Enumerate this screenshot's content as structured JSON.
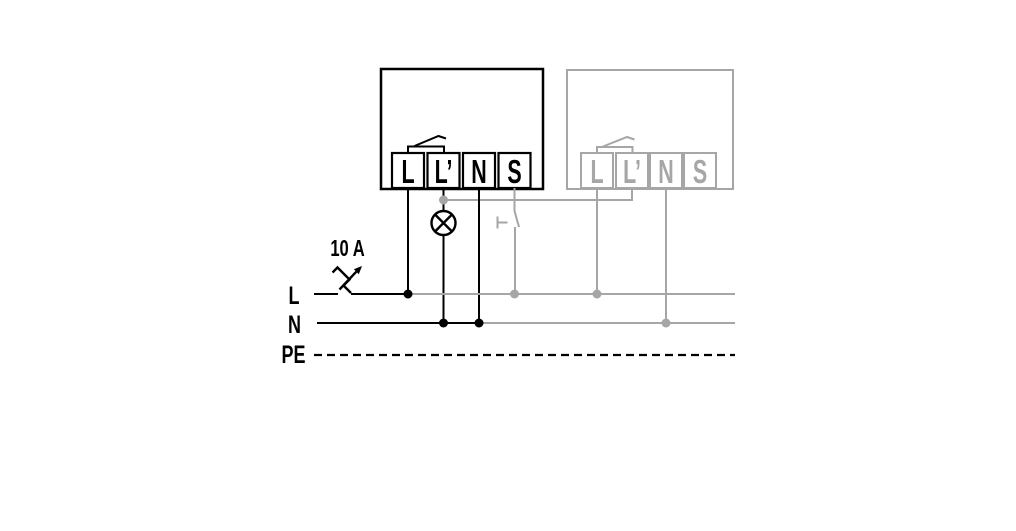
{
  "colors": {
    "active": "#000000",
    "inactive": "#a6a6a6",
    "background": "#ffffff"
  },
  "fuse": {
    "rating": "10 A"
  },
  "bus": {
    "l": "L",
    "n": "N",
    "pe": "PE"
  },
  "devices": {
    "active": {
      "terminals": {
        "l": "L",
        "lprime": "L’",
        "n": "N",
        "s": "S"
      }
    },
    "ghost": {
      "terminals": {
        "l": "L",
        "lprime": "L’",
        "n": "N",
        "s": "S"
      }
    }
  }
}
